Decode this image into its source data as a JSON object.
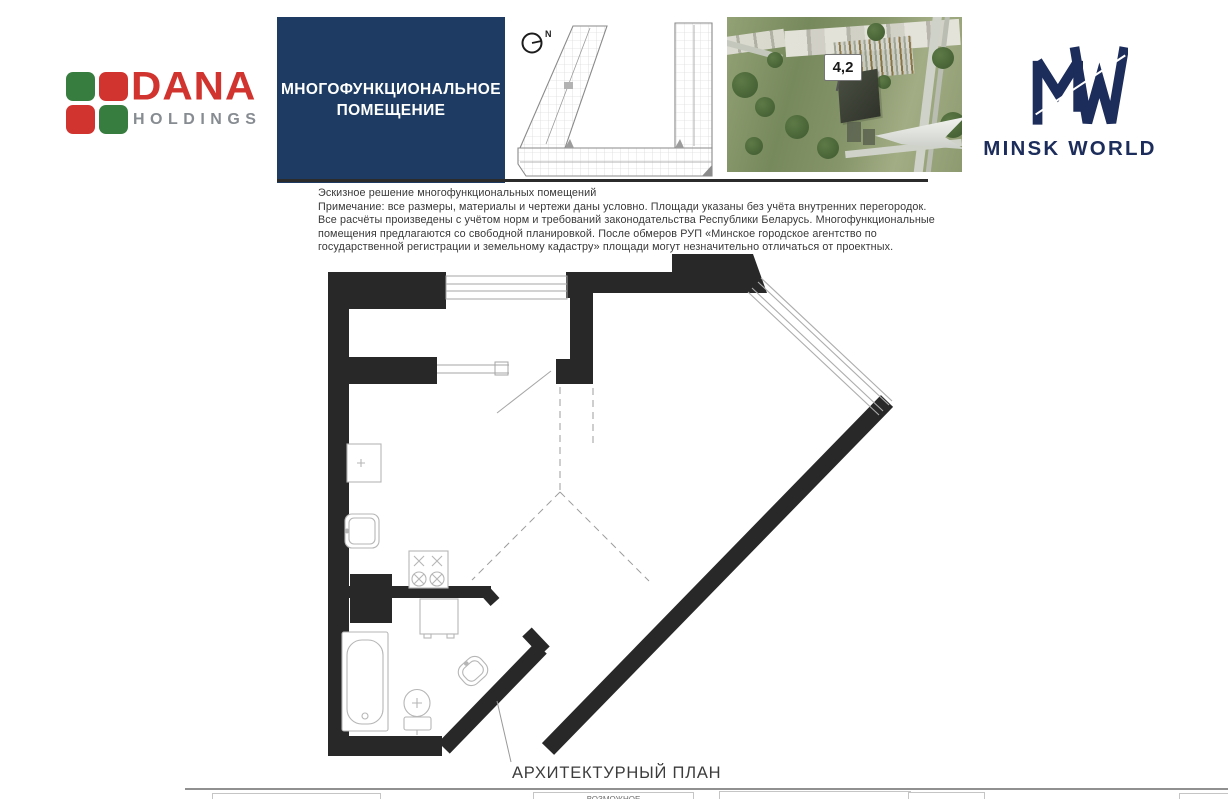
{
  "branding": {
    "dana": {
      "title": "DANA",
      "subtitle": "HOLDINGS",
      "red": "#d1342f",
      "green": "#377d3f",
      "gray": "#868c91"
    },
    "minsk_world": {
      "wordmark": "MINSK WORLD",
      "navy": "#1c2c5b"
    }
  },
  "title_box": {
    "line1": "МНОГОФУНКЦИОНАЛЬНОЕ",
    "line2": "ПОМЕЩЕНИЕ",
    "bg": "#1e3c63"
  },
  "key_plan": {
    "north_label": "N"
  },
  "aerial": {
    "marker_label": "4,2"
  },
  "notes": {
    "lines": [
      "Эскизное решение многофункциональных помещений",
      "Примечание: все размеры, материалы и чертежи даны условно. Площади указаны без учёта внутренних перегородок.",
      "Все расчёты произведены с учётом норм и требований законодательства Республики Беларусь. Многофункциональные",
      "помещения предлагаются со свободной планировкой. После обмеров РУП «Минское городское агентство по",
      "государственной регистрации и земельному кадастру» площади могут незначительно отличаться от проектных."
    ]
  },
  "plan": {
    "caption": "АРХИТЕКТУРНЫЙ ПЛАН",
    "wall_color": "#282828"
  },
  "footer": {
    "partial_label": "ВОЗМОЖНОЕ"
  }
}
